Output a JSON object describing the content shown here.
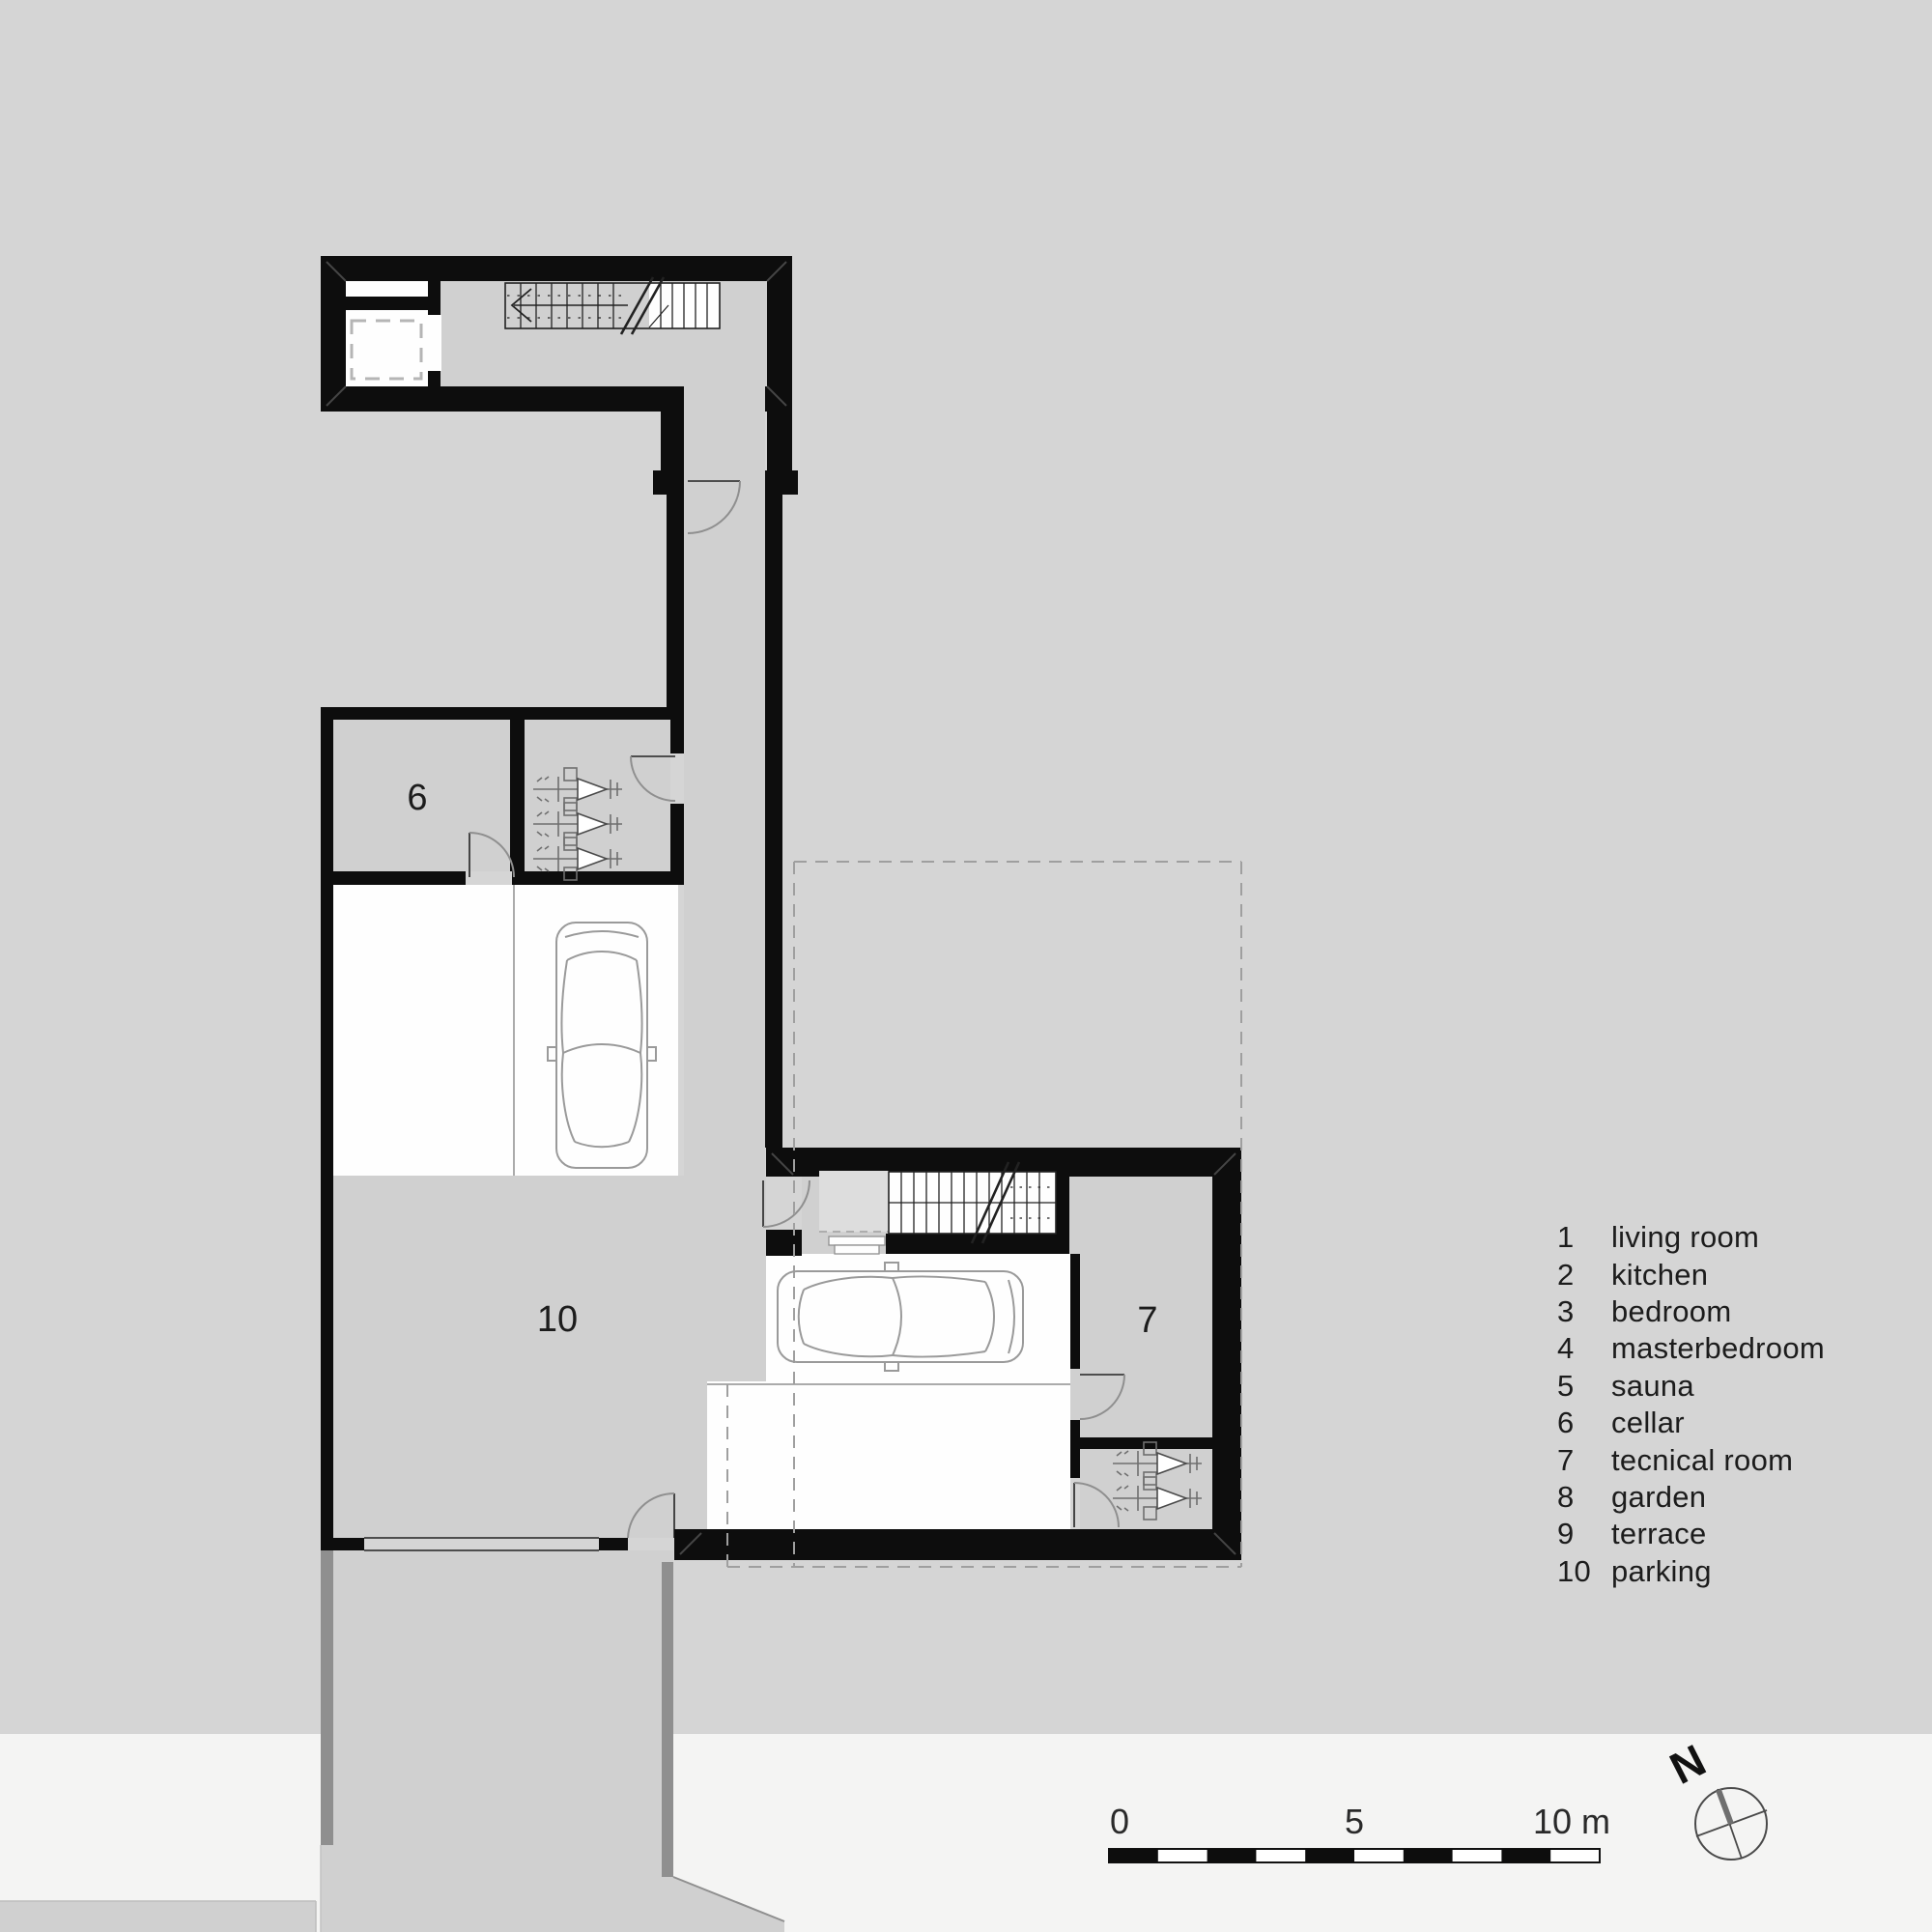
{
  "colors": {
    "background": "#d5d5d5",
    "band": "#f4f4f3",
    "wall": "#0d0d0d",
    "white": "#fefefe",
    "room": "#d0d0d0",
    "vestibule": "#dddddd",
    "stripe": "#8f8f8f",
    "text": "#1c1c1c"
  },
  "plan": {
    "rooms": {
      "cellar": "6",
      "technical": "7",
      "parking": "10"
    }
  },
  "legend": {
    "items": [
      {
        "num": "1",
        "label": "living room"
      },
      {
        "num": "2",
        "label": "kitchen"
      },
      {
        "num": "3",
        "label": "bedroom"
      },
      {
        "num": "4",
        "label": "masterbedroom"
      },
      {
        "num": "5",
        "label": "sauna"
      },
      {
        "num": "6",
        "label": "cellar"
      },
      {
        "num": "7",
        "label": "tecnical room"
      },
      {
        "num": "8",
        "label": "garden"
      },
      {
        "num": "9",
        "label": "terrace"
      },
      {
        "num": "10",
        "label": "parking"
      }
    ]
  },
  "scale_bar": {
    "labels": [
      "0",
      "5",
      "10 m"
    ]
  },
  "compass": {
    "label": "N"
  }
}
